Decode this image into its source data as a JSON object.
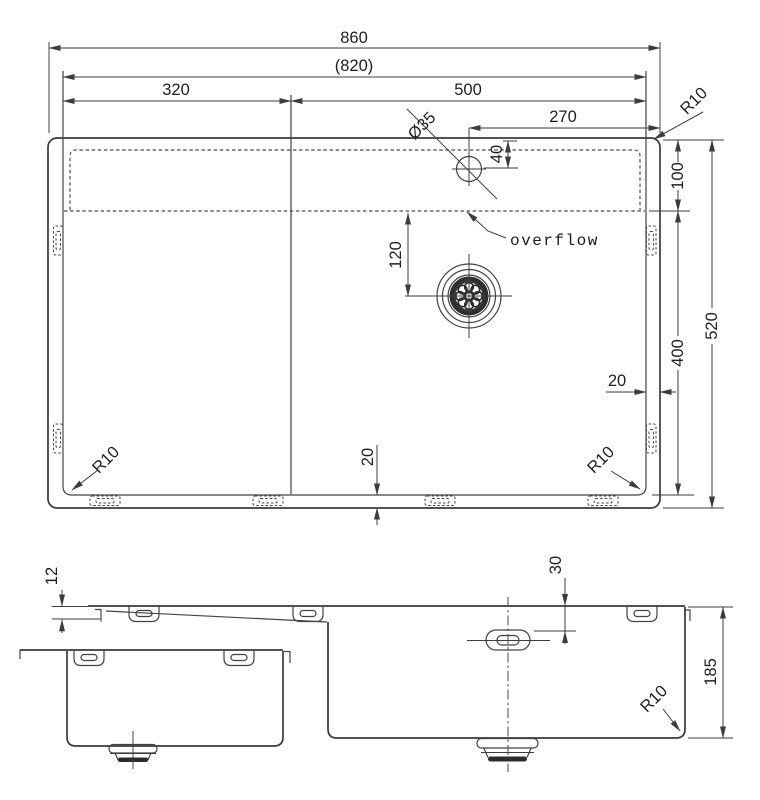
{
  "top_view": {
    "dims": {
      "overall_width": "860",
      "cutout_width": "(820)",
      "left_section_width": "320",
      "bowl_width": "500",
      "faucet_offset_from_right": "270",
      "faucet_hole_diameter": "Ø35",
      "faucet_offset_from_top": "40",
      "deck_depth": "100",
      "drain_offset_from_overflow": "120",
      "bowl_depth": "400",
      "overall_depth": "520",
      "rim_gap_right": "20",
      "rim_gap_bottom": "20",
      "corner_radius_top_right": "R10",
      "corner_radius_bottom_left": "R10",
      "corner_radius_bottom_right": "R10"
    },
    "labels": {
      "overflow": "overflow"
    }
  },
  "side_view": {
    "dims": {
      "rim_thickness": "12",
      "overflow_offset_from_top": "30",
      "bowl_height": "185",
      "corner_radius": "R10"
    }
  },
  "colors": {
    "line": "#3a3a3a",
    "text": "#1f1f1f",
    "background": "#ffffff"
  }
}
